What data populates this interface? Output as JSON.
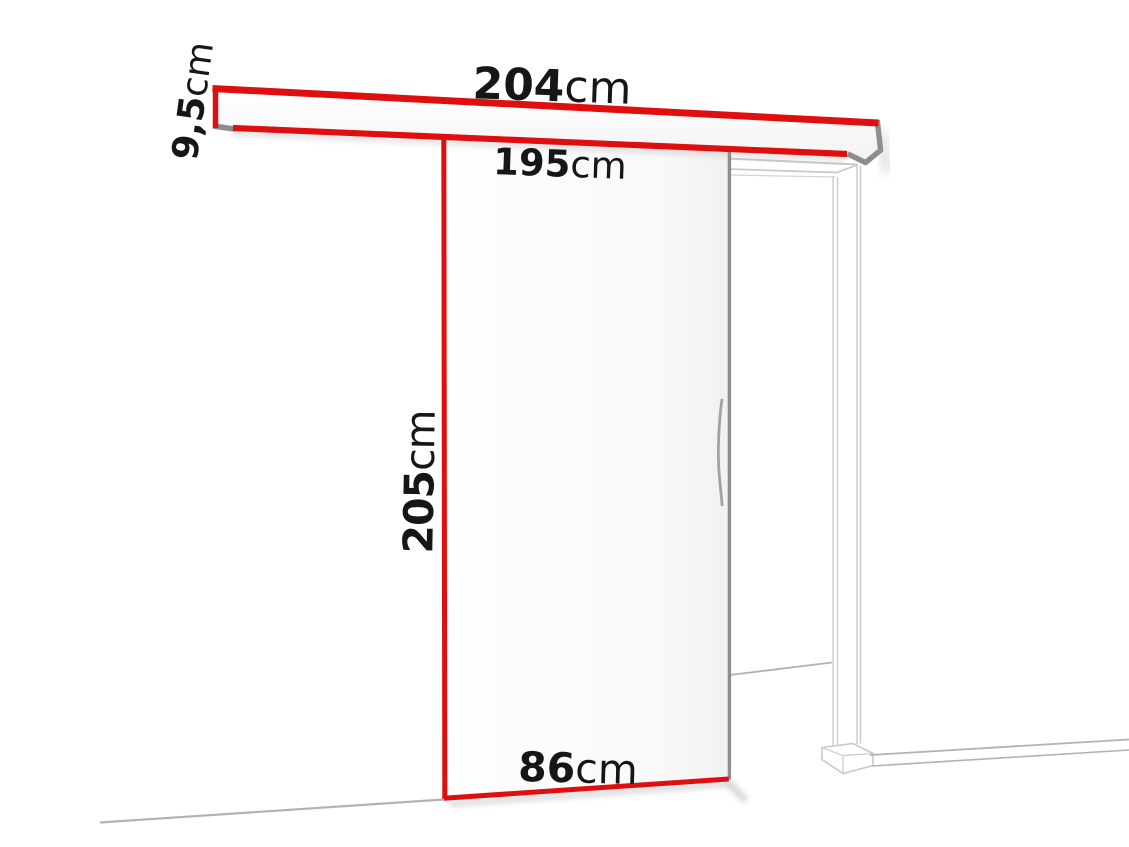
{
  "dimensions": {
    "rail_length": {
      "value": "204",
      "unit": "cm"
    },
    "rail_profile_height": {
      "value": "9,5",
      "unit": "cm"
    },
    "passage_width": {
      "value": "195",
      "unit": "cm"
    },
    "door_height": {
      "value": "205",
      "unit": "cm"
    },
    "door_width": {
      "value": "86",
      "unit": "cm"
    }
  },
  "colors": {
    "accent_red": "#e00f0f",
    "steel_gray": "#8d8d8d",
    "frame_gray": "#c9c9c9",
    "floor_gray": "#b2b2b2",
    "text_black": "#161616"
  }
}
